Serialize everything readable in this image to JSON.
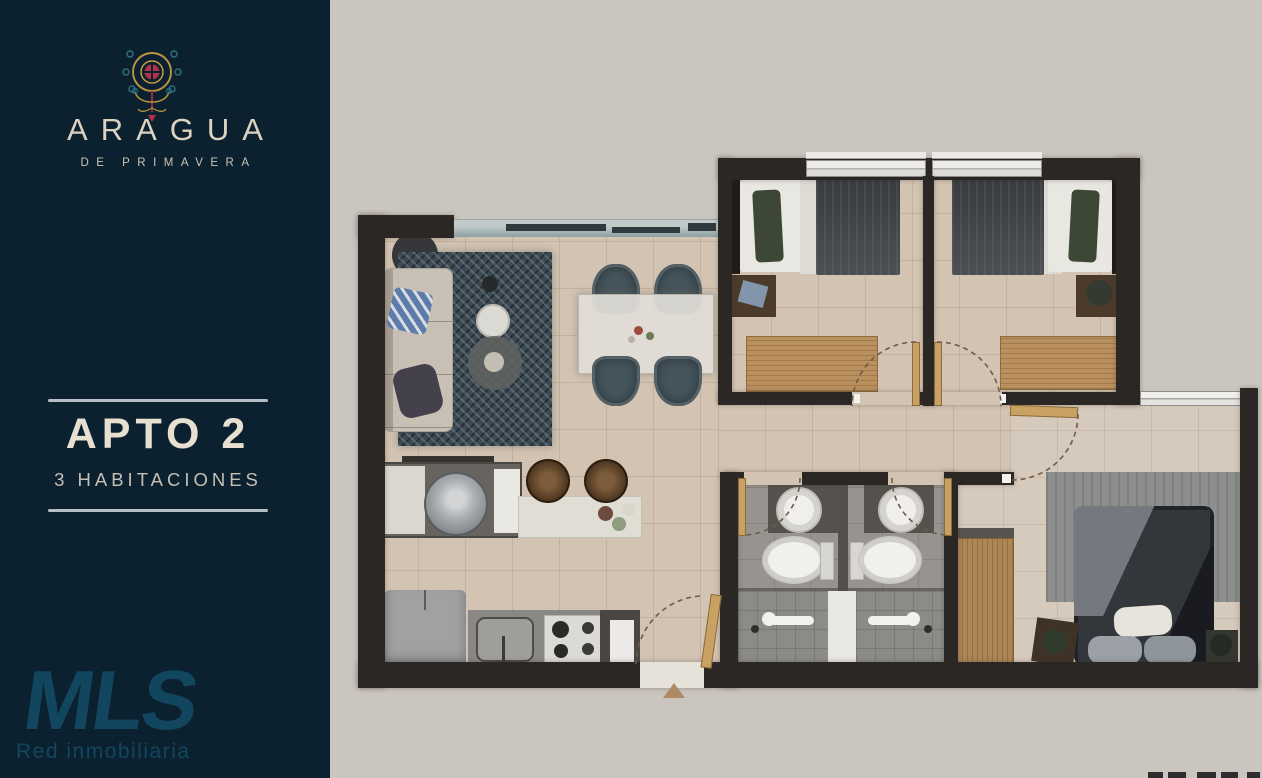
{
  "sidebar": {
    "brand_name": "ARAGUA",
    "brand_tagline": "DE PRIMAVERA",
    "unit_title": "APTO 2",
    "unit_subtitle": "3 HABITACIONES",
    "agency_name": "MLS",
    "agency_tagline": "Red inmobiliaria"
  },
  "colors": {
    "sidebar_bg": "#0c2130",
    "canvas_bg": "#cac5be",
    "title_cream": "#e7e0d1",
    "brand_cream": "#dbd2bf",
    "divider": "#b6bfc5",
    "agency_blue": "#12465f",
    "wall_dark": "#2b2724",
    "floor_tile": "#d2c3b2",
    "bath_tile": "#97948f",
    "wood": "#b9905e",
    "emblem_red": "#b23249",
    "emblem_gold": "#bb9240",
    "emblem_teal": "#2e6f7e"
  }
}
